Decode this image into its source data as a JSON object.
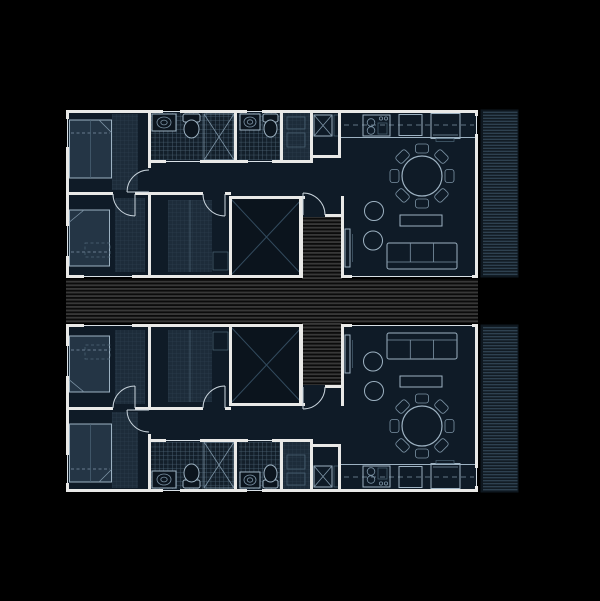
{
  "app": {
    "name": "architectural-floor-plan",
    "description": "Black-background architectural drawing of two mirrored apartment units joined by a central striped timber deck spine, each with a side terrace of horizontal decking"
  },
  "palette": {
    "bg": "#000000",
    "wall": "#e9e9e7",
    "room": "#0f1b27",
    "void": "#0b141d",
    "bed": "#243545",
    "fixture": "#0c151e",
    "line_strong": "#9db2c2",
    "line_mid": "#7d94a6",
    "line_faint": "#4e6577",
    "window_line": "#d8e0e6",
    "arc_line": "#c9d4dc",
    "deck_base": "#0b0b0b",
    "deck_stripe": "#383838",
    "deck_stripe2": "#2e2e2e",
    "terrace_base": "#0e171f",
    "terrace_stripe": "#2e4150",
    "tile_base": "#131f2a",
    "tile_line": "#4e6577",
    "closet_base": "#1d2c3a",
    "closet_line": "#2b3d4c",
    "void_cross": "#334b5e"
  },
  "plan": {
    "canvas": {
      "width": 600,
      "height": 601
    },
    "units": [
      {
        "id": "unit-upper",
        "position": "top"
      },
      {
        "id": "unit-lower",
        "position": "bottom",
        "mirror_of": "unit-upper"
      }
    ],
    "rooms_per_unit": [
      "bedroom-1",
      "bedroom-2",
      "bathroom-1",
      "bathroom-2",
      "utility-closet",
      "laundry-closet",
      "hallway",
      "dressing-room",
      "kitchen",
      "living-dining-room",
      "patio-void",
      "entry-vestibule"
    ],
    "outdoor_elements": [
      "central-deck-walkway",
      "entry-walkway",
      "side-terrace"
    ],
    "furniture_per_unit": [
      "double-bed",
      "single-bed",
      "wardrobe",
      "desk",
      "washbasin",
      "toilet",
      "shower-stall",
      "washing-machine",
      "stove",
      "dishwasher",
      "fridge",
      "round-dining-table",
      "dining-chairs-x8",
      "pouf",
      "pouf",
      "coffee-table",
      "sofa",
      "tv-console"
    ]
  }
}
